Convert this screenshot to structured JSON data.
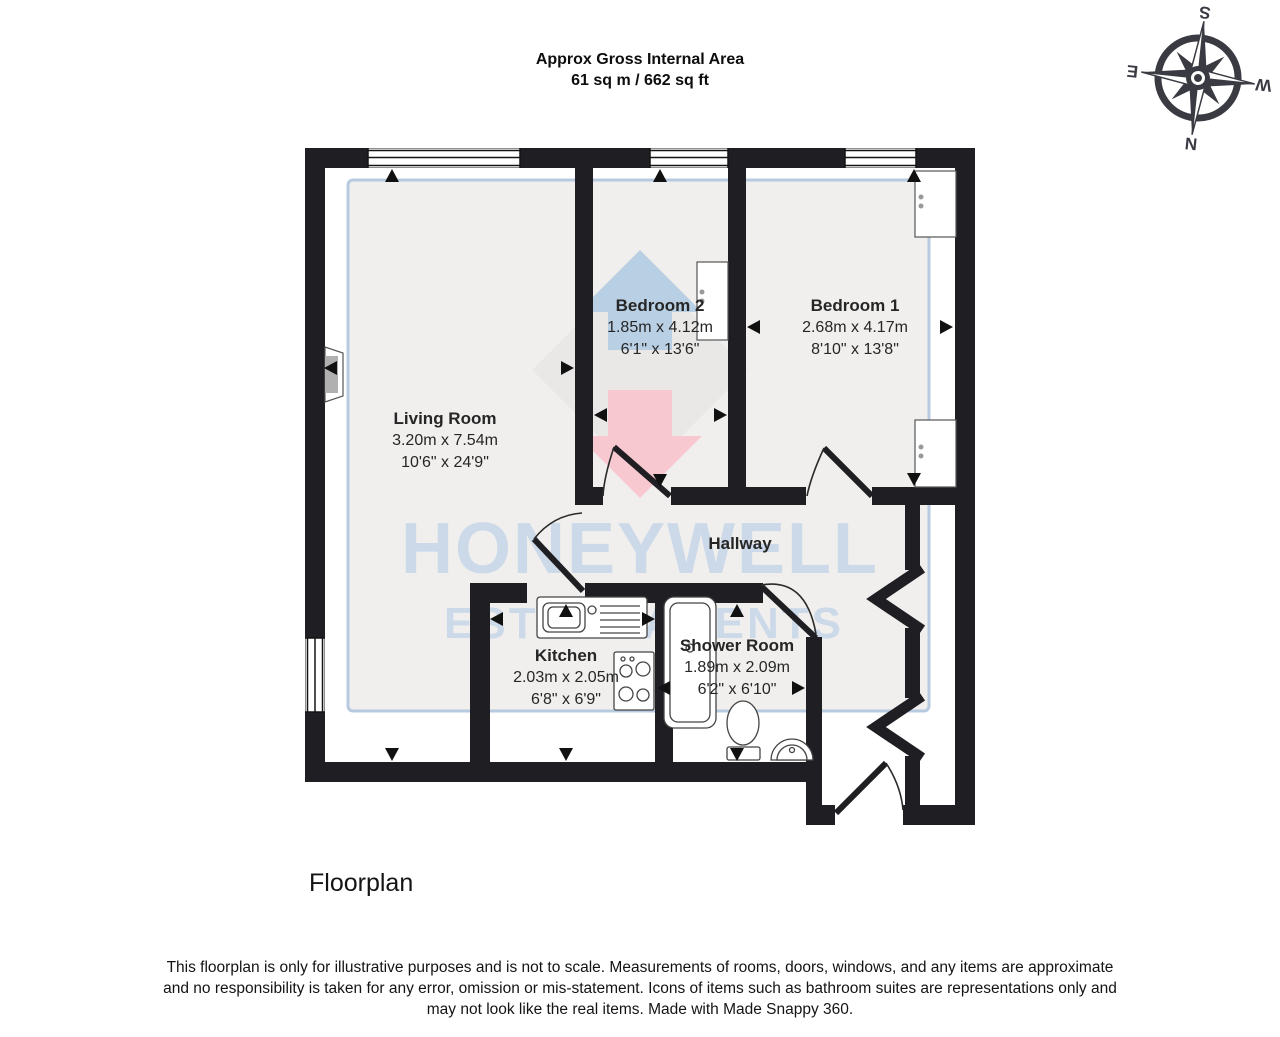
{
  "header": {
    "title": "Approx Gross Internal Area",
    "subtitle": "61 sq m / 662 sq ft"
  },
  "compass": {
    "north": "N",
    "east": "E",
    "south": "S",
    "west": "W"
  },
  "watermark": {
    "brand": "HONEYWELL",
    "tagline": "ESTATE AGENTS"
  },
  "rooms": [
    {
      "name": "Living Room",
      "metric": "3.20m x 7.54m",
      "imperial": "10'6\" x 24'9\""
    },
    {
      "name": "Bedroom 2",
      "metric": "1.85m x 4.12m",
      "imperial": "6'1\" x 13'6\""
    },
    {
      "name": "Bedroom 1",
      "metric": "2.68m x 4.17m",
      "imperial": "8'10\" x 13'8\""
    },
    {
      "name": "Hallway"
    },
    {
      "name": "Kitchen",
      "metric": "2.03m x 2.05m",
      "imperial": "6'8\" x 6'9\""
    },
    {
      "name": "Shower Room",
      "metric": "1.89m x 2.09m",
      "imperial": "6'2\" x 6'10\""
    }
  ],
  "caption": "Floorplan",
  "disclaimer": {
    "line1": "This floorplan is only for illustrative purposes and is not to scale. Measurements of rooms, doors, windows, and any items are approximate",
    "line2": "and no responsibility is taken for any error, omission or mis-statement. Icons of items such as bathroom suites are representations only and",
    "line3": "may not look like the real items. Made with Made Snappy 360."
  },
  "colors": {
    "wall": "#1f1f23",
    "watermark_text": "#ccd9e9",
    "watermark_border": "#b7cadf",
    "floor_tint": "#f0efee",
    "logo_blue": "#b9cfe4",
    "logo_pink": "#f8c8d0",
    "logo_gray": "#e9e8e7",
    "compass": "#3a3a43"
  }
}
